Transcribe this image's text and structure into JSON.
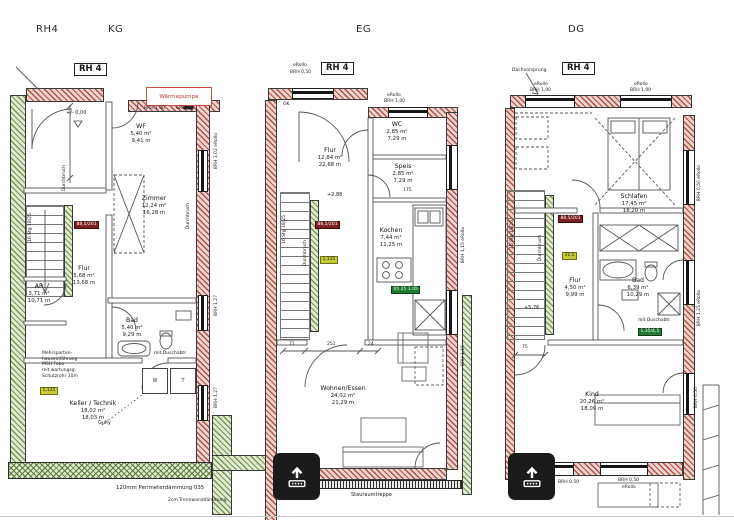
{
  "header": {
    "project": "RH4",
    "kg": "KG",
    "eg": "EG",
    "dg": "DG"
  },
  "colors": {
    "wall_hatch": "#b0504b",
    "insulation_hatch": "#77964f",
    "door_tag_bg": "#7e1f1f",
    "window_tag_bg": "#c6ca35",
    "green_tag_bg": "#1f7a32",
    "heat_pump_outline": "#c84a45",
    "overlay_bg": "#1b1b1b"
  },
  "plans": {
    "kg": {
      "title": "RH 4",
      "level": "+/- 0,00",
      "rooms": {
        "wf": {
          "name": "WF",
          "area": "5,40 m²",
          "perimeter": "9,41 m"
        },
        "zimmer": {
          "name": "Zimmer",
          "area": "12,24 m²",
          "perimeter": "16,28 m"
        },
        "flur": {
          "name": "Flur",
          "area": "5,68 m²",
          "perimeter": "13,68 m"
        },
        "ar": {
          "name": "AR",
          "area": "3,71 m²",
          "perimeter": "10,71 m"
        },
        "bad": {
          "name": "Bad",
          "area": "5,40 m²",
          "perimeter": "9,29 m"
        },
        "keller": {
          "name": "Keller / Technik",
          "area": "18,02 m²",
          "perimeter": "18,03 m"
        }
      },
      "heat_pump": "Wärmepumpe",
      "gully": "Gully",
      "top_window_1": "BRH 1,00",
      "top_window_2": "eRollo",
      "right_top": "BRH 1,02 eRollo",
      "right_mid": "BRH 1,27",
      "right_bottom": "BRH 1,27",
      "stair_text": "16 Stg 18/25",
      "duct_1": "Durchbruch",
      "duct_2": "Durchbruch",
      "door_tag": "88,5/201",
      "window_tag": "1,135",
      "shower_note": "mit Duschabtr.",
      "washer": "W",
      "dryer": "T",
      "utility_note": [
        "Mehrsparten-",
        "hauseinführung",
        "MSH Febo",
        "mit wartungsg.",
        "Schutzrohr 10m"
      ],
      "perimeter_note": "120mm Perimeterdämmung 035",
      "partition_note": "2cm Trennwanddämmung"
    },
    "eg": {
      "title": "RH 4",
      "level": "+2,88",
      "ok_label": "OK",
      "rooms": {
        "flur": {
          "name": "Flur",
          "area": "12,84 m²",
          "perimeter": "22,68 m"
        },
        "wc": {
          "name": "WC",
          "area": "2,85 m²",
          "perimeter": "7,29 m"
        },
        "speis": {
          "name": "Speis",
          "area": "2,85 m²",
          "perimeter": "7,29 m"
        },
        "kochen": {
          "name": "Kochen",
          "area": "7,44 m²",
          "perimeter": "11,25 m"
        },
        "wohnen": {
          "name": "Wohnen/Essen",
          "area": "24,02 m²",
          "perimeter": "21,29 m"
        }
      },
      "window_tl_1": "eRollo",
      "window_tl_2": "BRH 0,50",
      "window_wc_1": "eRollo",
      "window_wc_2": "BRH 1,00",
      "right_top": "BRH 1,15 eRollo",
      "right_bottom": "BRH 1,15",
      "stair_text": "16 Stg 18/25",
      "duct": "Durchbruch",
      "door_tag": "88,5/201",
      "window_tag": "1,135",
      "kitchen_tag": "05 25 1 05",
      "dims": {
        "a": "71",
        "b": "251",
        "c": "24",
        "speis": "175"
      },
      "bottom_note": "Stauraumtreppe",
      "bottom_small": "eRollo"
    },
    "dg": {
      "title": "RH 4",
      "level": "+5,76",
      "roof_note": "Dachvorsprung",
      "rooms": {
        "schlafen": {
          "name": "Schlafen",
          "area": "17,45 m²",
          "perimeter": "18,20 m"
        },
        "flur": {
          "name": "Flur",
          "area": "4,50 m²",
          "perimeter": "9,99 m"
        },
        "bad": {
          "name": "Bad",
          "area": "6,39 m²",
          "perimeter": "10,29 m"
        },
        "kind": {
          "name": "Kind",
          "area": "20,26 m²",
          "perimeter": "18,09 m"
        }
      },
      "window_t1_1": "eRollo",
      "window_t1_2": "BRH 1,00",
      "window_t2_1": "eRollo",
      "window_t2_2": "BRH 1,00",
      "window_b1": "BRH 0,50",
      "window_b2_1": "BRH 0,50",
      "window_b2_2": "eRollo",
      "right_top": "BRH 0,50 eRollo",
      "right_mid": "BRH 1,25 eRollo",
      "right_bottom": "BRH 0,50",
      "stair_text": "16 Stg 18/25",
      "duct": "Durchbruch",
      "door_tag": "88,5/201",
      "window_tag": "31,5",
      "green_tag": "1,35/4,5",
      "shower_note": "mit Duschabtr.",
      "dim_a": "75"
    }
  }
}
